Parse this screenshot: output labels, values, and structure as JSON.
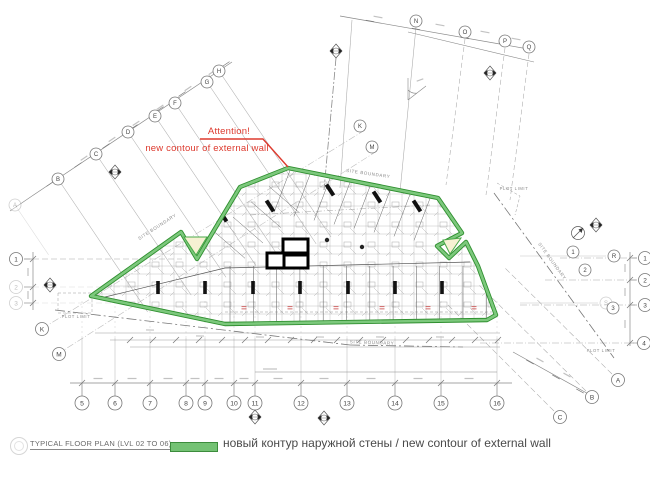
{
  "title_block": {
    "label": "TYPICAL FLOOR PLAN  (LVL 02 TO 06)"
  },
  "legend": {
    "swatch_color": "#74c274",
    "text": "новый контур наружной стены / new contour of external wall"
  },
  "annotation": {
    "line1": "Attention!",
    "line2": "new contour of external wall",
    "color": "#dd3a2e"
  },
  "labels": {
    "site_boundary": "SITE BOUNDARY",
    "plot_limit": "PLOT LIMIT"
  },
  "colors": {
    "contour_green": "#7cc87c",
    "contour_green_dark": "#2f8f2f",
    "infill_yellow": "#f6f1d3",
    "red": "#dd3a2e",
    "grid": "#a8a8a8",
    "ink": "#4a4a4a"
  },
  "contour": {
    "outer": [
      [
        91,
        296
      ],
      [
        181,
        232
      ],
      [
        197,
        259
      ],
      [
        213,
        232
      ],
      [
        240,
        187
      ],
      [
        288,
        168
      ],
      [
        438,
        198
      ],
      [
        462,
        233
      ],
      [
        437,
        246
      ],
      [
        449,
        258
      ],
      [
        466,
        242
      ],
      [
        478,
        266
      ],
      [
        496,
        315
      ],
      [
        487,
        320
      ],
      [
        225,
        324
      ]
    ],
    "left_notch": [
      [
        184,
        237
      ],
      [
        196,
        255
      ],
      [
        207,
        237
      ]
    ],
    "right_notch": [
      [
        443,
        240
      ],
      [
        450,
        254
      ],
      [
        461,
        238
      ]
    ]
  },
  "grid_bubbles": {
    "diag_letters": [
      {
        "label": "A",
        "x": 15,
        "y": 205,
        "faint": true
      },
      {
        "label": "B",
        "x": 58,
        "y": 179
      },
      {
        "label": "C",
        "x": 96,
        "y": 154
      },
      {
        "label": "D",
        "x": 128,
        "y": 132
      },
      {
        "label": "E",
        "x": 155,
        "y": 116
      },
      {
        "label": "F",
        "x": 175,
        "y": 103
      },
      {
        "label": "G",
        "x": 207,
        "y": 82
      },
      {
        "label": "H",
        "x": 219,
        "y": 71
      }
    ],
    "top_letters": [
      {
        "label": "N",
        "x": 416,
        "y": 21
      },
      {
        "label": "O",
        "x": 465,
        "y": 32
      },
      {
        "label": "P",
        "x": 505,
        "y": 41
      },
      {
        "label": "Q",
        "x": 529,
        "y": 47
      },
      {
        "label": "K",
        "x": 360,
        "y": 126
      },
      {
        "label": "M",
        "x": 372,
        "y": 147
      }
    ],
    "right_numbers": [
      {
        "label": "1",
        "x": 645,
        "y": 258
      },
      {
        "label": "2",
        "x": 645,
        "y": 280
      },
      {
        "label": "3",
        "x": 645,
        "y": 305
      },
      {
        "label": "4",
        "x": 644,
        "y": 343
      }
    ],
    "right_inner": [
      {
        "label": "1",
        "x": 573,
        "y": 252
      },
      {
        "label": "R",
        "x": 614,
        "y": 256
      },
      {
        "label": "2",
        "x": 585,
        "y": 270
      },
      {
        "label": "S",
        "x": 606,
        "y": 303,
        "faint": true
      },
      {
        "label": "3",
        "x": 613,
        "y": 308
      }
    ],
    "bottom_numbers": [
      {
        "label": "5",
        "x": 82,
        "y": 403
      },
      {
        "label": "6",
        "x": 115,
        "y": 403
      },
      {
        "label": "7",
        "x": 150,
        "y": 403
      },
      {
        "label": "8",
        "x": 186,
        "y": 403
      },
      {
        "label": "9",
        "x": 205,
        "y": 403
      },
      {
        "label": "10",
        "x": 234,
        "y": 403
      },
      {
        "label": "11",
        "x": 255,
        "y": 403
      },
      {
        "label": "12",
        "x": 301,
        "y": 403
      },
      {
        "label": "13",
        "x": 347,
        "y": 403
      },
      {
        "label": "14",
        "x": 395,
        "y": 403
      },
      {
        "label": "15",
        "x": 441,
        "y": 403
      },
      {
        "label": "16",
        "x": 497,
        "y": 403
      }
    ],
    "bottom_right_letters": [
      {
        "label": "A",
        "x": 618,
        "y": 380
      },
      {
        "label": "B",
        "x": 592,
        "y": 397
      },
      {
        "label": "C",
        "x": 560,
        "y": 417
      }
    ],
    "left_side": [
      {
        "label": "1",
        "x": 16,
        "y": 259
      },
      {
        "label": "2",
        "x": 16,
        "y": 287,
        "faint": true
      },
      {
        "label": "3",
        "x": 16,
        "y": 303,
        "faint": true
      },
      {
        "label": "K",
        "x": 42,
        "y": 329
      },
      {
        "label": "M",
        "x": 59,
        "y": 354
      }
    ]
  },
  "site_boundary_labels": [
    {
      "x": 158,
      "y": 228,
      "rot": -33
    },
    {
      "x": 368,
      "y": 175,
      "rot": 8
    },
    {
      "x": 372,
      "y": 344,
      "rot": 2
    },
    {
      "x": 551,
      "y": 262,
      "rot": 54
    }
  ],
  "plot_limit_labels": [
    {
      "x": 76,
      "y": 318,
      "rot": 0
    },
    {
      "x": 514,
      "y": 190,
      "rot": 0
    },
    {
      "x": 601,
      "y": 352,
      "rot": 0
    }
  ]
}
